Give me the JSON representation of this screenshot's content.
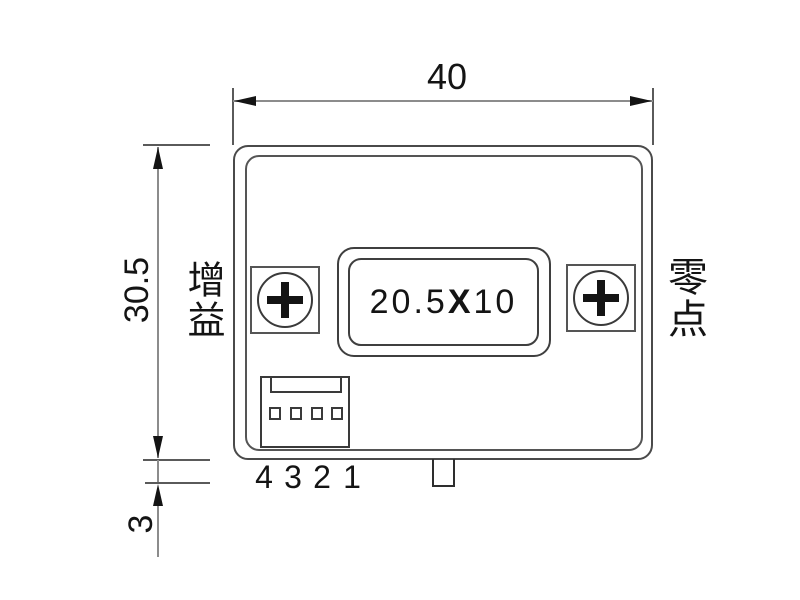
{
  "dimension_width": {
    "label": "40"
  },
  "dimension_height": {
    "label": "30.5"
  },
  "dimension_tab": {
    "label": "3"
  },
  "side_labels": {
    "gain": "增益",
    "zero": "零点"
  },
  "display": {
    "value": "20.5X10",
    "prefix": "20.5",
    "multiplier": "X",
    "suffix": "10"
  },
  "connector": {
    "pin_labels": [
      "4",
      "3",
      "2",
      "1"
    ]
  },
  "colors": {
    "background": "#ffffff",
    "outline": "#4a4a4a",
    "dimension_line": "#8c8c8c",
    "text": "#141414"
  }
}
